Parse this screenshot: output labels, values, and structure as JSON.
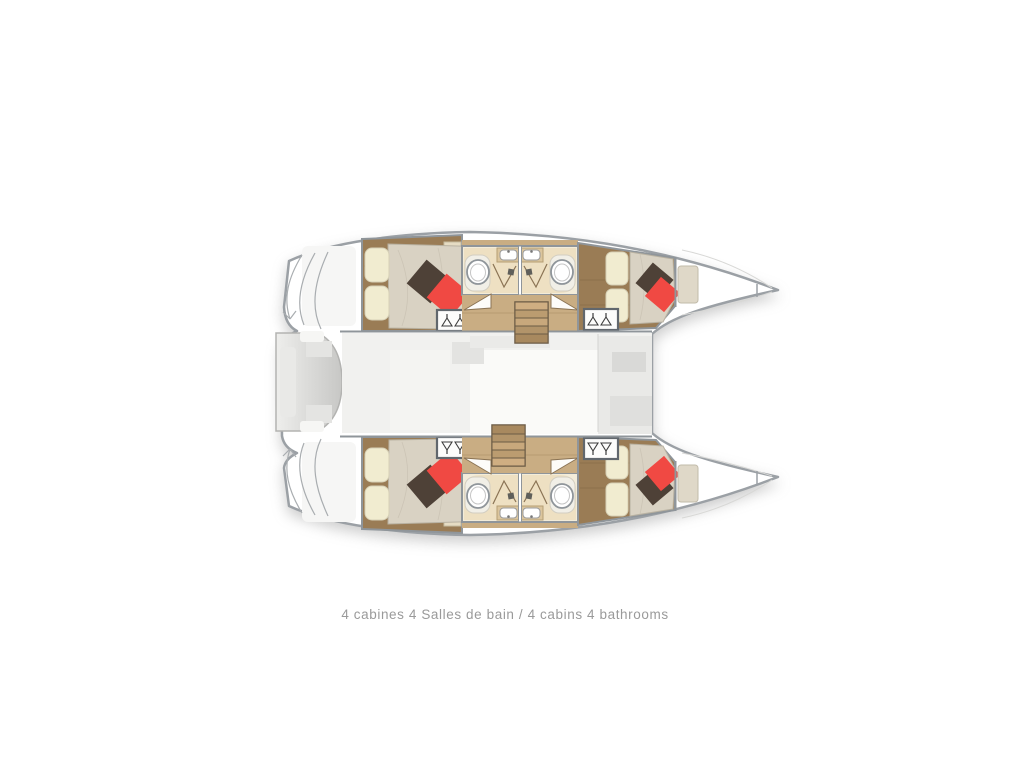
{
  "caption": {
    "text": "4 cabines 4 Salles de bain / 4 cabins 4 bathrooms"
  },
  "colors": {
    "outline": "#9ba0a5",
    "wall": "#8f959a",
    "wood-floor": "#9a7c55",
    "wood-light": "#c9ad83",
    "bed-duvet": "#d9d2c3",
    "bed-pillow": "#f1ecd0",
    "pillow-red": "#f04943",
    "pillow-brown": "#4e4137",
    "bath-floor": "#eee0c2",
    "bath-counter": "#dbc59d",
    "stair-wood": "#c2a37a",
    "stair-frame": "#6b5b45",
    "cockpit-gray": "#d8d8d6",
    "saloon-gray": "#f1f1ef",
    "caption-text": "#9a9a9a"
  }
}
